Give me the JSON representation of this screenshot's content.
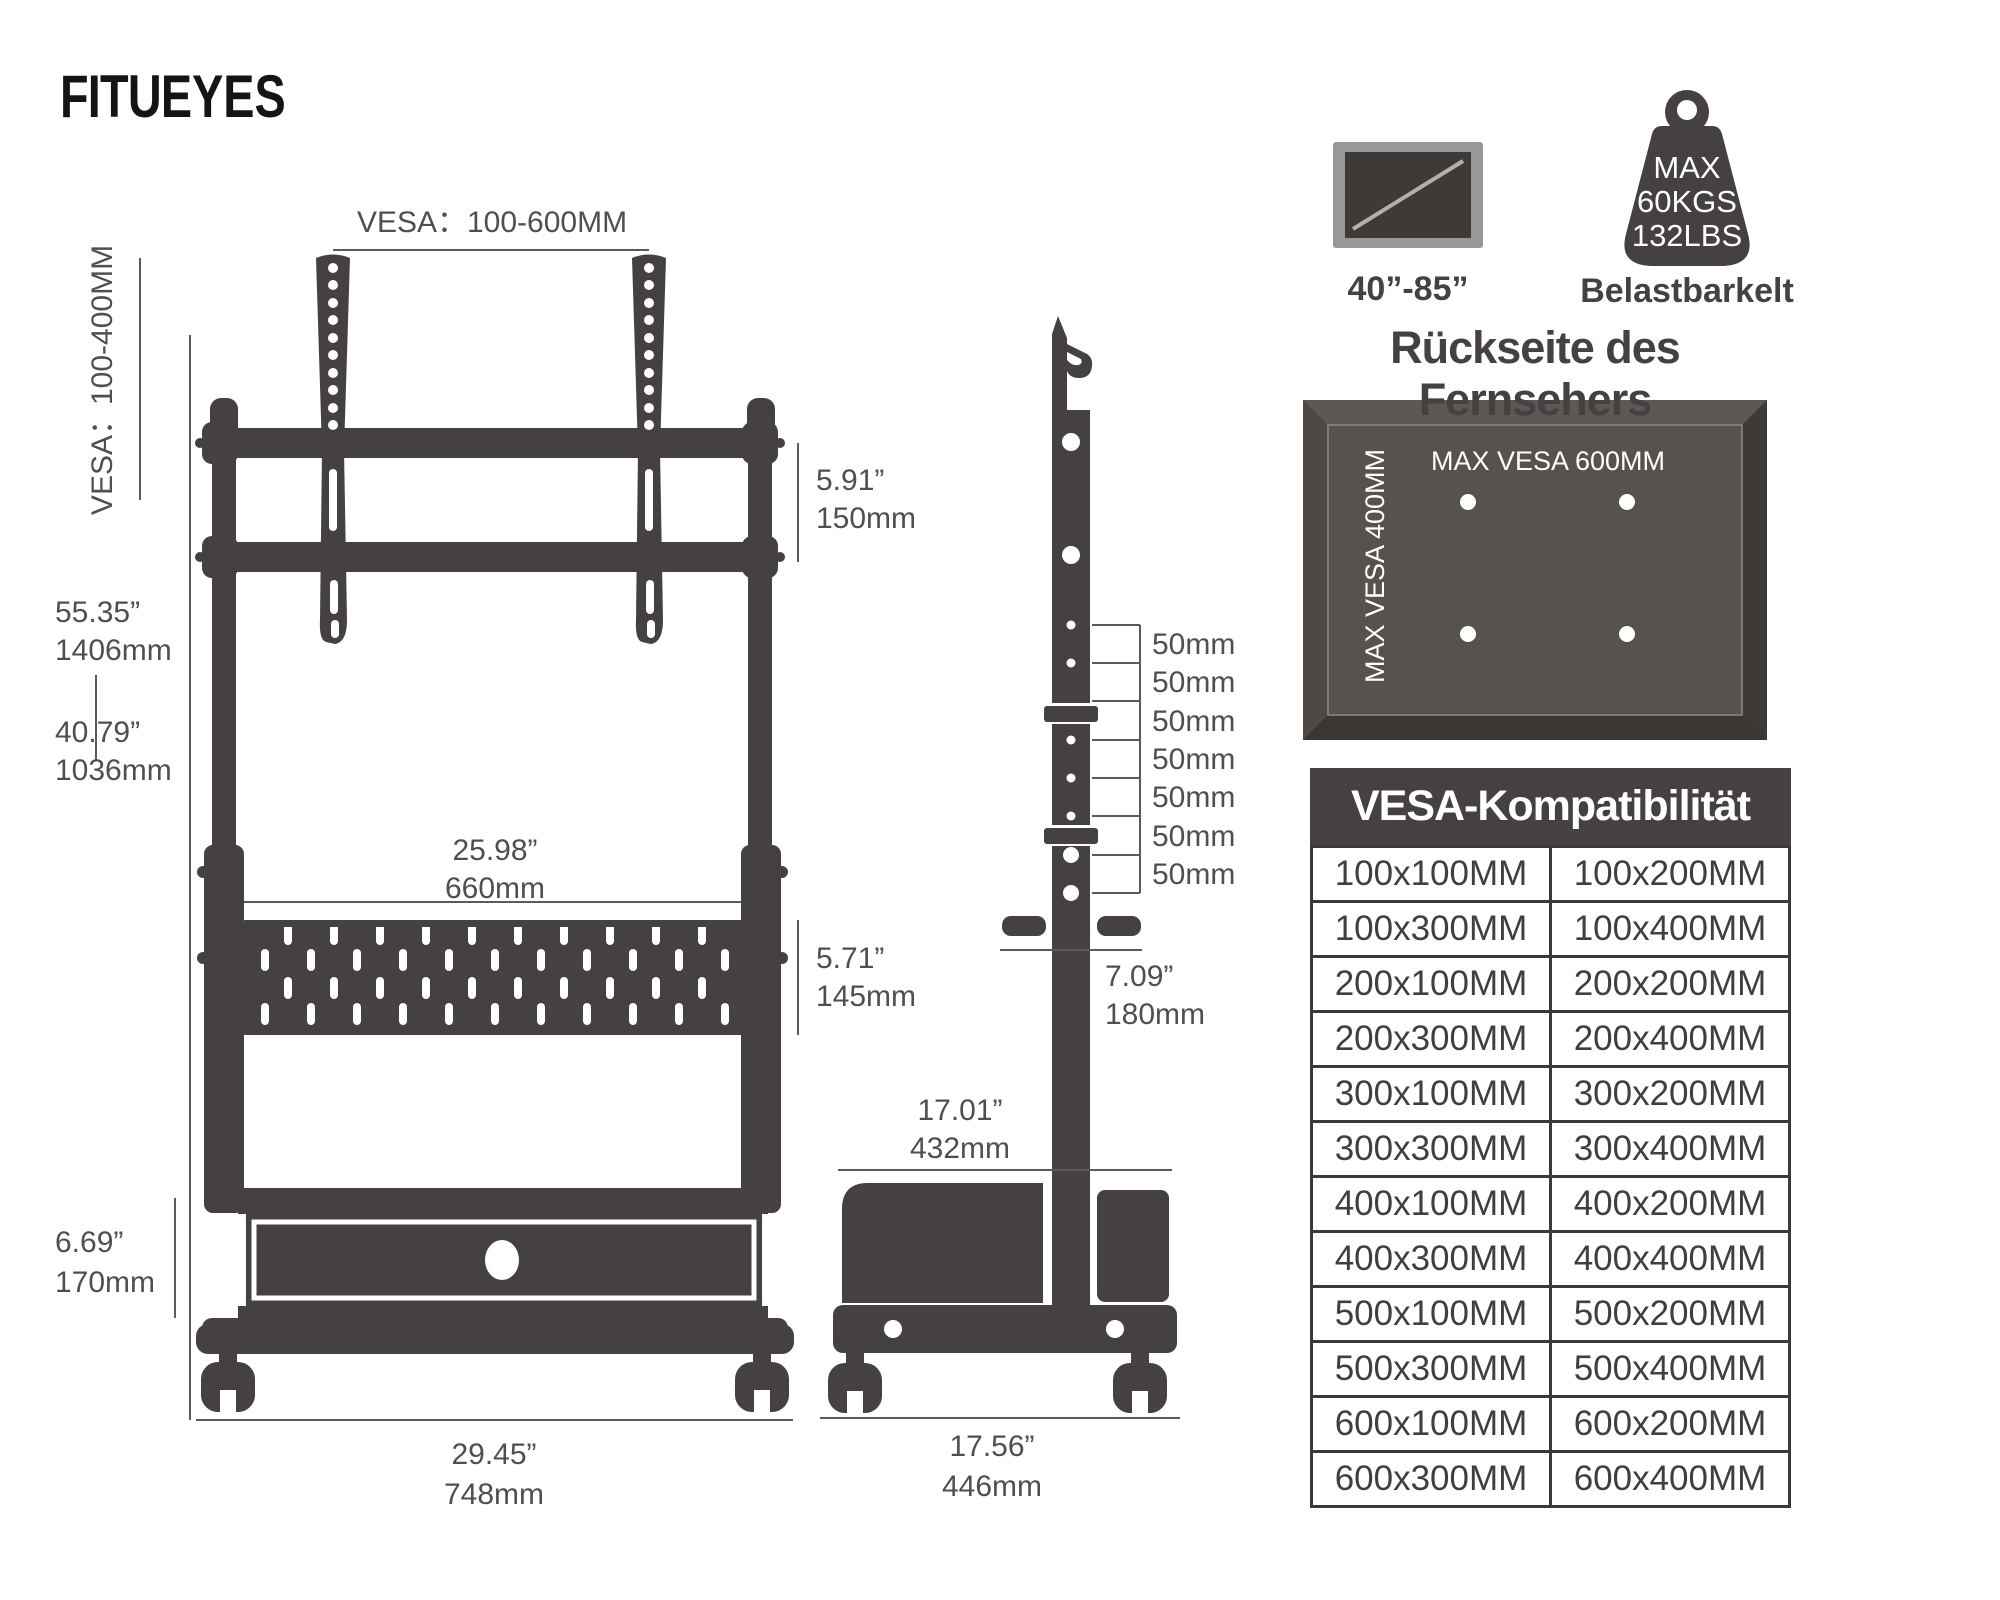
{
  "brand": {
    "logo_fitu": "FITU",
    "logo_eyes": "EYES"
  },
  "front_view": {
    "vesa_range_top": "VESA：100-600MM",
    "vesa_range_left": "VESA：100-400MM",
    "total_height_in": "55.35”",
    "total_height_mm": "1406mm",
    "mid_height_in": "40.79”",
    "mid_height_mm": "1036mm",
    "drawer_height_in": "6.69”",
    "drawer_height_mm": "170mm",
    "shelf_width_in": "25.98”",
    "shelf_width_mm": "660mm",
    "bracket_height_in": "5.91”",
    "bracket_height_mm": "150mm",
    "shelf_height_in": "5.71”",
    "shelf_height_mm": "145mm",
    "base_width_in": "29.45”",
    "base_width_mm": "748mm"
  },
  "side_view": {
    "increments": [
      "50mm",
      "50mm",
      "50mm",
      "50mm",
      "50mm",
      "50mm",
      "50mm"
    ],
    "depth_in": "7.09”",
    "depth_mm": "180mm",
    "inner_depth_in": "17.01”",
    "inner_depth_mm": "432mm",
    "base_depth_in": "17.56”",
    "base_depth_mm": "446mm"
  },
  "badges": {
    "screen_range": "40”-85”",
    "weight_max": "MAX",
    "weight_kg": "60KGS",
    "weight_lbs": "132LBS",
    "weight_caption": "Belastbarkelt"
  },
  "tv_back": {
    "title": "Rückseite des Fernsehers",
    "max_vesa_width": "MAX VESA 600MM",
    "max_vesa_height": "MAX VESA 400MM"
  },
  "vesa_table": {
    "title": "VESA-Kompatibilität",
    "rows": [
      [
        "100x100MM",
        "100x200MM"
      ],
      [
        "100x300MM",
        "100x400MM"
      ],
      [
        "200x100MM",
        "200x200MM"
      ],
      [
        "200x300MM",
        "200x400MM"
      ],
      [
        "300x100MM",
        "300x200MM"
      ],
      [
        "300x300MM",
        "300x400MM"
      ],
      [
        "400x100MM",
        "400x200MM"
      ],
      [
        "400x300MM",
        "400x400MM"
      ],
      [
        "500x100MM",
        "500x200MM"
      ],
      [
        "500x300MM",
        "500x400MM"
      ],
      [
        "600x100MM",
        "600x200MM"
      ],
      [
        "600x300MM",
        "600x400MM"
      ]
    ]
  },
  "colors": {
    "ink": "#454041",
    "panel": "#57524e",
    "accent_white": "#ffffff"
  }
}
